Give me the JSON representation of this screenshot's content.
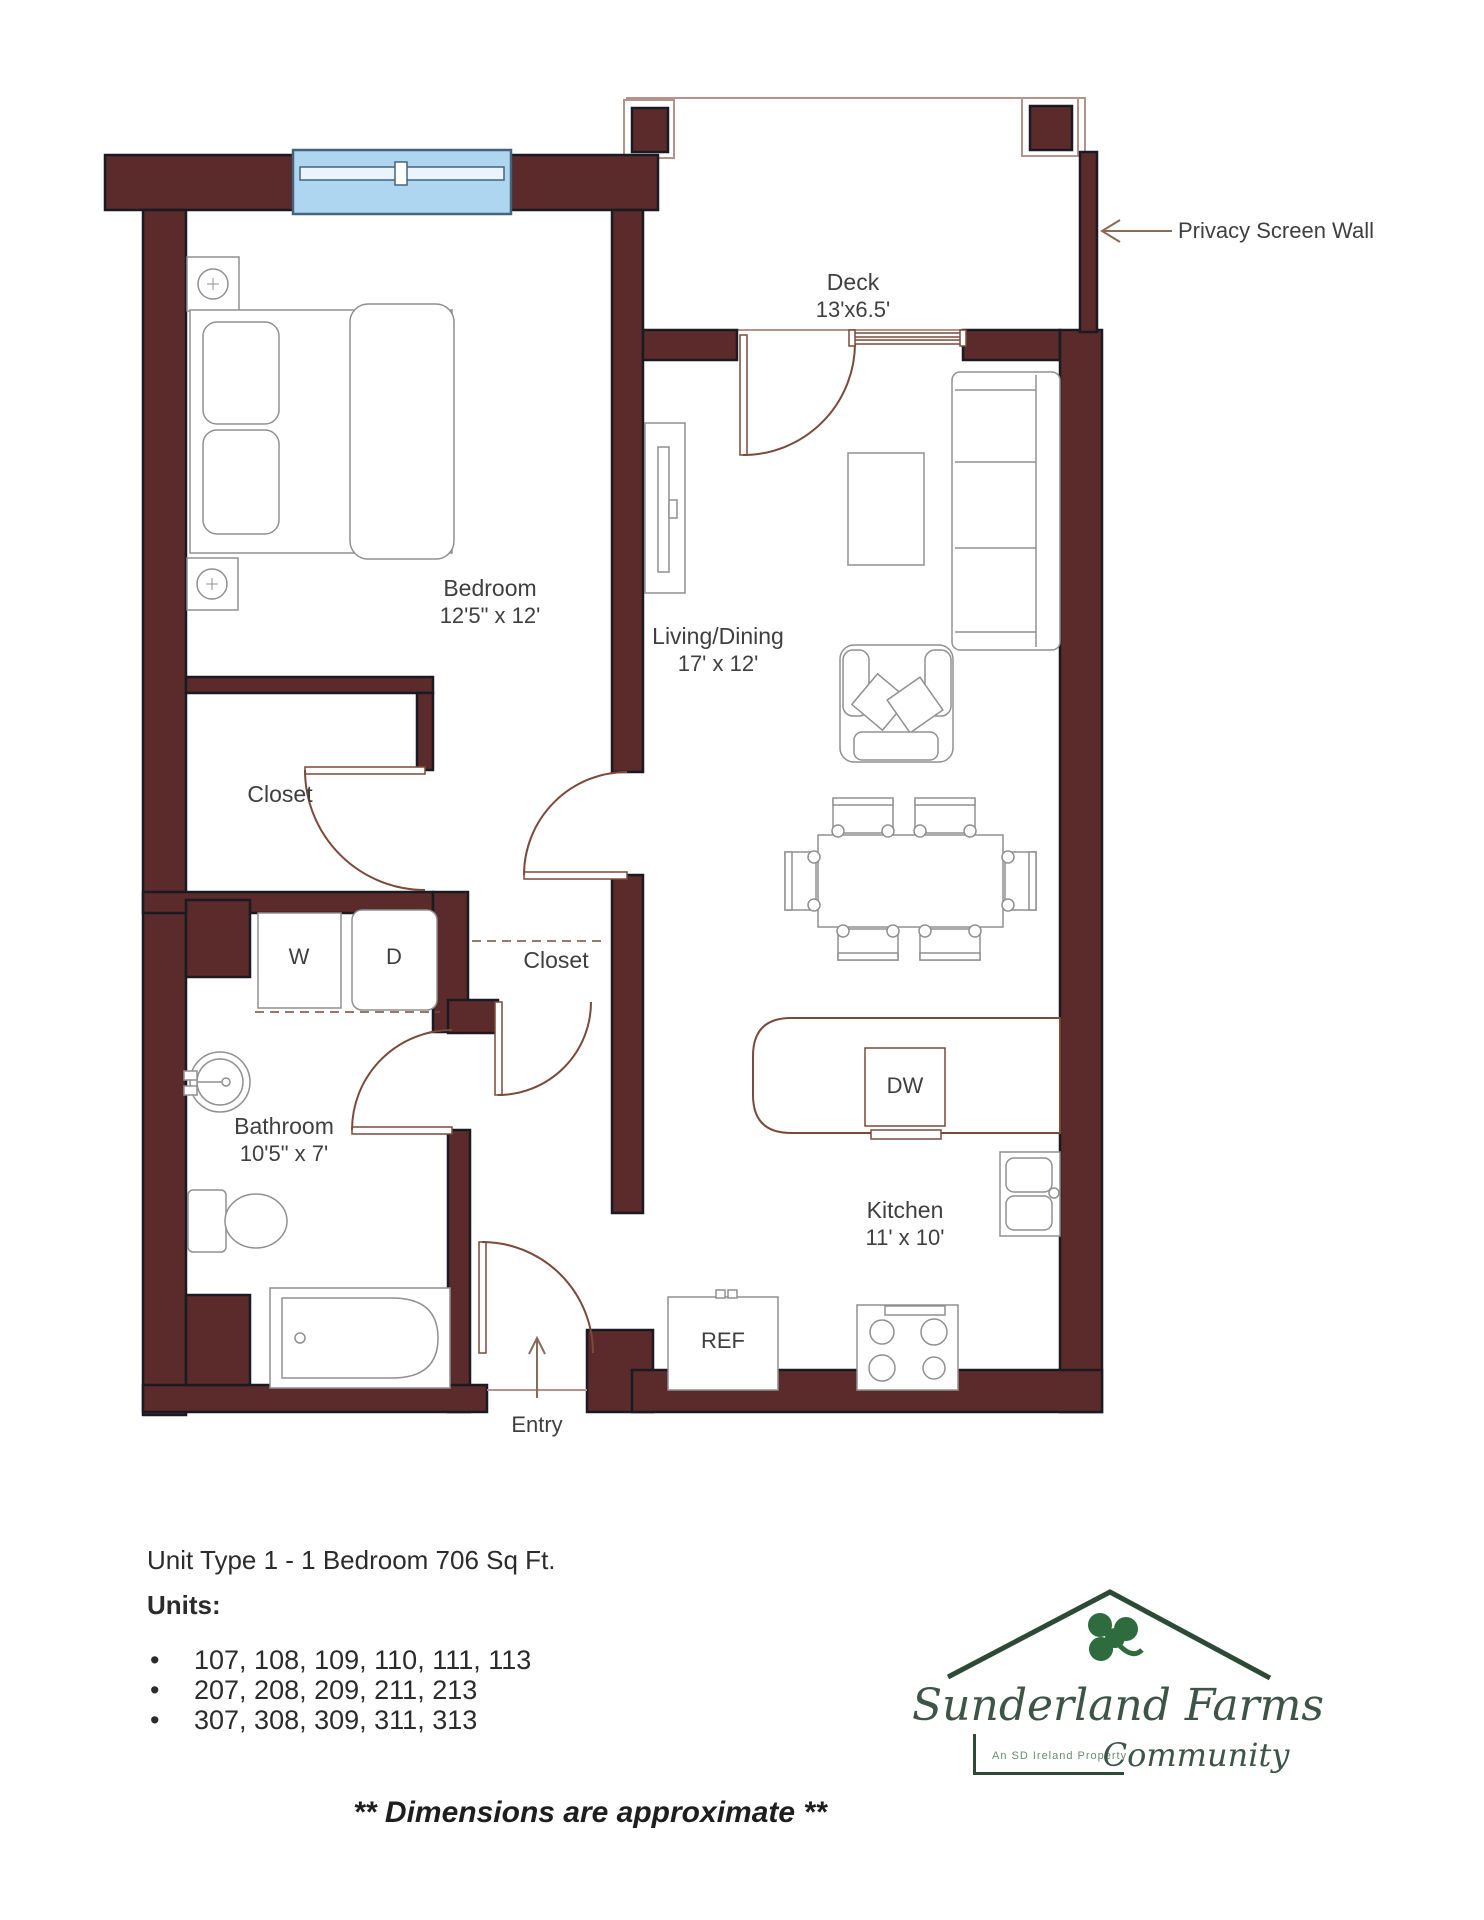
{
  "rooms": {
    "deck": {
      "label": "Deck",
      "dims": "13'x6.5'"
    },
    "bedroom": {
      "label": "Bedroom",
      "dims": "12'5\" x 12'"
    },
    "living": {
      "label": "Living/Dining",
      "dims": "17' x 12'"
    },
    "bedroom_closet": {
      "label": "Closet"
    },
    "hall_closet": {
      "label": "Closet"
    },
    "bathroom": {
      "label": "Bathroom",
      "dims": "10'5\" x 7'"
    },
    "kitchen": {
      "label": "Kitchen",
      "dims": "11' x 10'"
    }
  },
  "appliances": {
    "washer": "W",
    "dryer": "D",
    "dishwasher": "DW",
    "refrigerator": "REF"
  },
  "annotations": {
    "privacy_wall": "Privacy Screen Wall",
    "entry": "Entry"
  },
  "footer": {
    "unit_type": "Unit Type 1 - 1 Bedroom  706 Sq Ft.",
    "units_label": "Units:",
    "bullet": "•",
    "units": [
      "107, 108, 109, 110, 111, 113",
      "207, 208, 209, 211, 213",
      "307, 308, 309, 311, 313"
    ],
    "disclaimer": "** Dimensions are approximate **"
  },
  "logo": {
    "name": "Sunderland Farms",
    "tagline": "An SD Ireland Property",
    "community": "Community",
    "icon": "shamrock-icon"
  },
  "colors": {
    "wall": "#5b2a2a",
    "wall_edge": "#1a1a22",
    "window": "#aed6f1",
    "door": "#7a4a3a",
    "furniture": "#909090",
    "logo_green": "#2d4a36",
    "shamrock_green": "#2e6b3e"
  }
}
